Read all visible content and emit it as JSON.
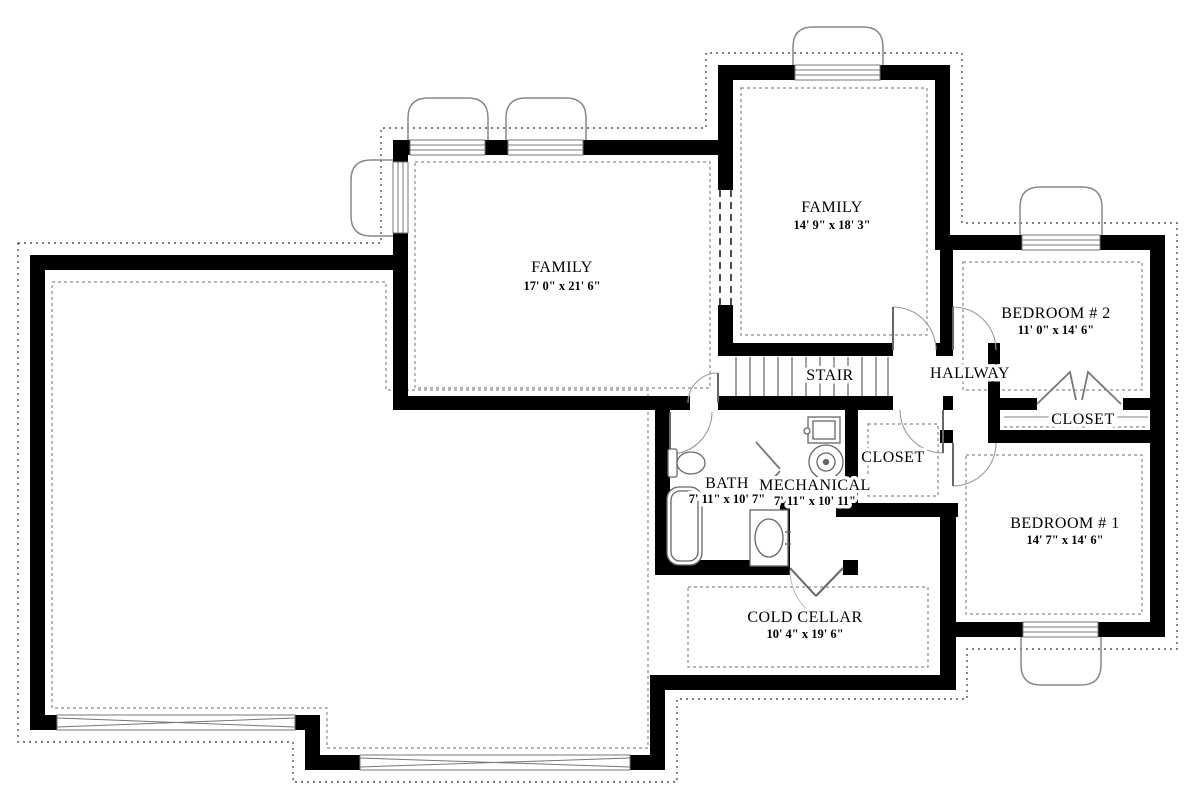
{
  "plan": {
    "rooms": {
      "family_left": {
        "label": "FAMILY",
        "dims": "17' 0\" x 21' 6\""
      },
      "family_upper": {
        "label": "FAMILY",
        "dims": "14' 9\" x 18' 3\""
      },
      "bedroom2": {
        "label": "BEDROOM # 2",
        "dims": "11' 0\" x 14' 6\""
      },
      "bedroom1": {
        "label": "BEDROOM # 1",
        "dims": "14' 7\" x 14' 6\""
      },
      "bath": {
        "label": "BATH",
        "dims": "7' 11\" x 10' 7\""
      },
      "mechanical": {
        "label": "MECHANICAL",
        "dims": "7' 11\" x 10' 11\""
      },
      "cold_cellar": {
        "label": "COLD CELLAR",
        "dims": "10' 4\" x 19' 6\""
      },
      "stair": {
        "label": "STAIR"
      },
      "hallway": {
        "label": "HALLWAY"
      },
      "closet_hall": {
        "label": "CLOSET"
      },
      "closet_bedroom2": {
        "label": "CLOSET"
      }
    },
    "colors": {
      "wall": "#000000",
      "fixture_line": "#666666",
      "dash_line": "#8a8a8a",
      "paper": "#ffffff"
    }
  }
}
